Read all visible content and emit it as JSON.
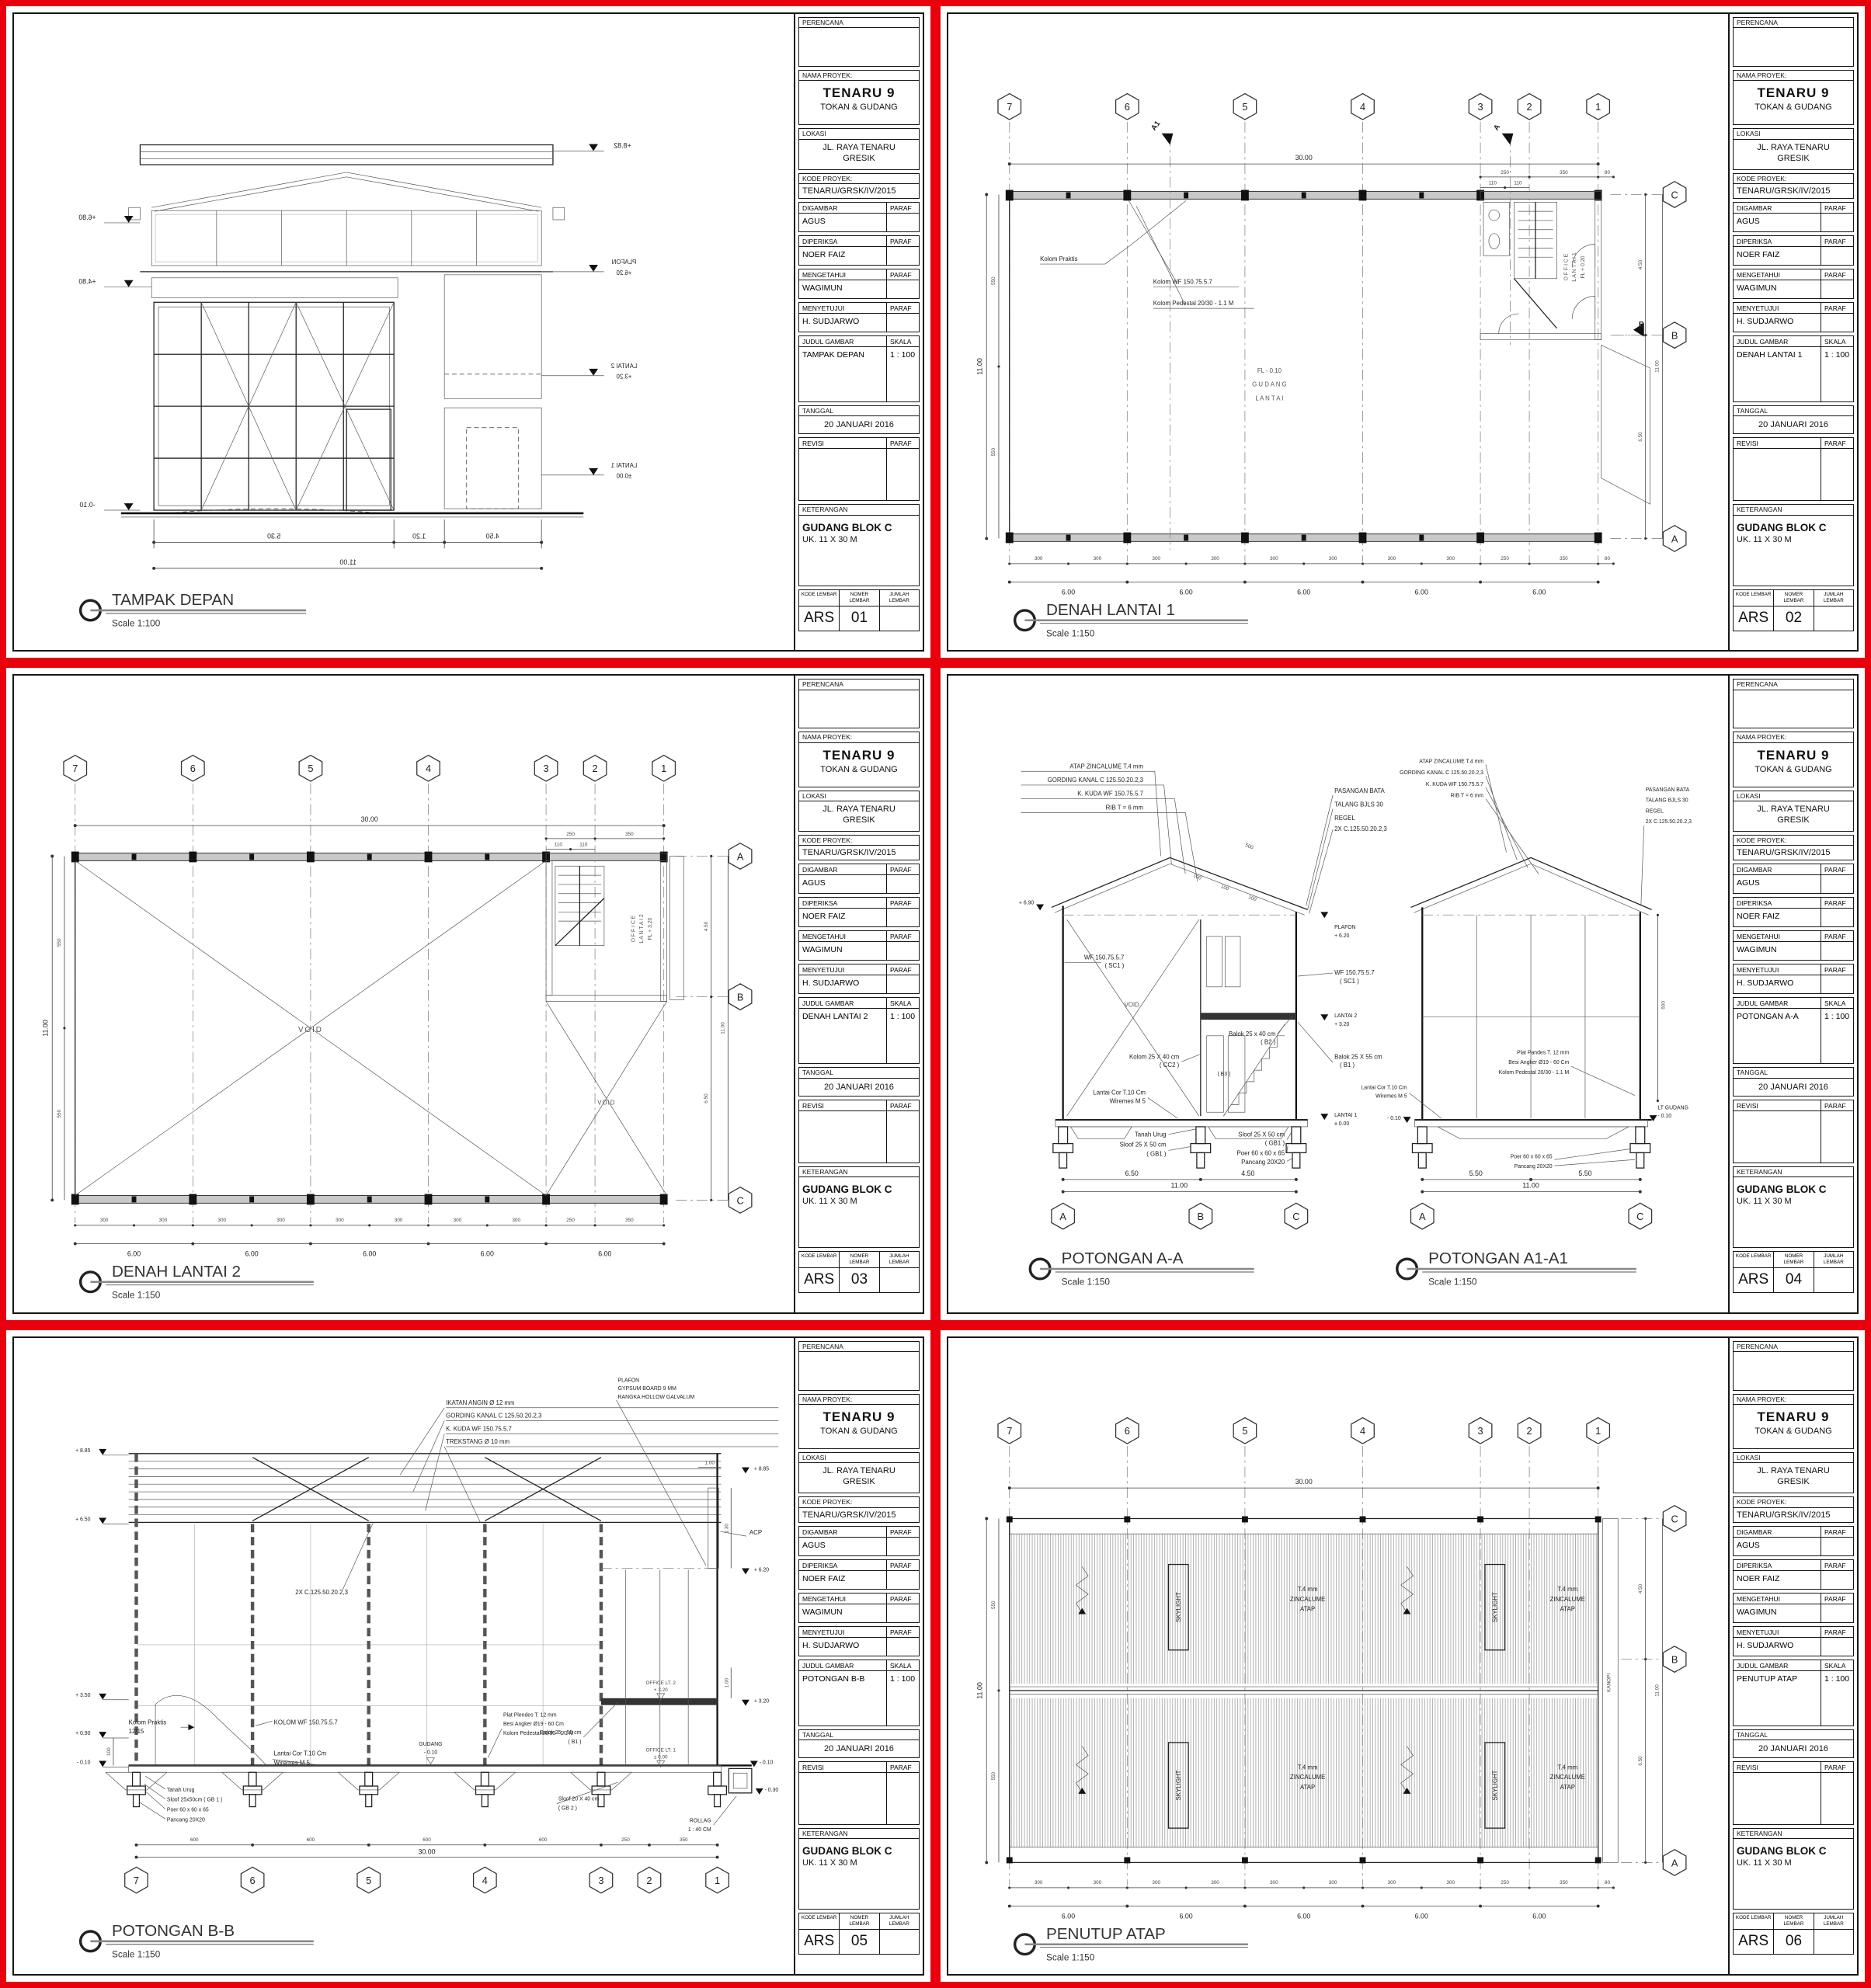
{
  "palette": {
    "separator_red": "#e8000d",
    "line_ink": "#161616"
  },
  "tb": {
    "perencana": "PERENCANA",
    "nama_proyek": "NAMA PROYEK:",
    "lokasi": "LOKASI",
    "kode_proyek": "KODE PROYEK:",
    "digambar": "DIGAMBAR",
    "diperiksa": "DIPERIKSA",
    "mengetahui": "MENGETAHUI",
    "menyetujui": "MENYETUJUI",
    "paraf": "PARAF",
    "judul_gambar": "JUDUL GAMBAR",
    "skala": "SKALA",
    "tanggal": "TANGGAL",
    "revisi": "REVISI",
    "keterangan": "KETERANGAN",
    "kode_lembar": "KODE LEMBAR",
    "nomer_lembar": "NOMER LEMBAR",
    "jumlah_lembar": "JUMLAH LEMBAR"
  },
  "project": {
    "name": "TENARU 9",
    "subtitle": "TOKAN & GUDANG",
    "lokasi_line1": "JL. RAYA TENARU",
    "lokasi_line2": "GRESIK",
    "kode": "TENARU/GRSK/IV/2015",
    "digambar": "AGUS",
    "diperiksa": "NOER FAIZ",
    "mengetahui": "WAGIMUN",
    "menyetujui": "H. SUDJARWO",
    "tanggal": "20 JANUARI 2016",
    "keterangan_line1": "GUDANG BLOK C",
    "keterangan_line2": "UK. 11 X 30 M",
    "kode_lembar": "ARS"
  },
  "grid": {
    "cols": [
      "7",
      "6",
      "5",
      "4",
      "3",
      "2",
      "1"
    ],
    "rows_cba": [
      "C",
      "B",
      "A"
    ],
    "rows_abc": [
      "A",
      "B",
      "C"
    ]
  },
  "dims": {
    "total_len": "30.00",
    "bay": "6.00",
    "width": "11.00",
    "half_bay": "300",
    "half_width": "550",
    "d250": "250",
    "d350": "350",
    "d80": "80",
    "d110": "110",
    "d450": "4.50",
    "d650": "6.50"
  },
  "sheets": [
    {
      "judul": "TAMPAK DEPAN",
      "skala": "1 : 100",
      "nomer": "01",
      "caption": "TAMPAK DEPAN",
      "caption_scale": "Scale 1:100",
      "d": {
        "lv882": "+8.82",
        "lv680": "+6.80",
        "plafon": "PLAFON",
        "lv620": "+6.20",
        "lv480": "+4.80",
        "lantai2": "LANTAI 2",
        "lv320": "+3.20",
        "lantai1": "LANTAI 1",
        "lv000": "±0.00",
        "lv010": "-0.10",
        "dim1": "5.30",
        "dim2": "1.20",
        "dim3": "4.50",
        "dim_total": "11.00"
      }
    },
    {
      "judul": "DENAH LANTAI 1",
      "skala": "1 : 100",
      "nomer": "02",
      "caption": "DENAH LANTAI 1",
      "caption_scale": "Scale 1:150",
      "d": {
        "sec_a1": "A1",
        "sec_a": "A",
        "sec_b": "B",
        "kolom_praktis": "Kolom Praktis",
        "kolom_wf": "Kolom WF 150.75.5.7",
        "kolom_ped": "Kolom Pedestal 20/30 - 1.1 M",
        "gudang1": "FL - 0.10",
        "gudang2": "G U D A N G",
        "gudang3": "L A N T A I",
        "office1": "O F F I C E",
        "office2": "L A N T A I  1",
        "office3": "FL + 0.20"
      }
    },
    {
      "judul": "DENAH LANTAI 2",
      "skala": "1 : 100",
      "nomer": "03",
      "caption": "DENAH LANTAI 2",
      "caption_scale": "Scale 1:150",
      "d": {
        "void": "VOID",
        "office1": "O F F I C E",
        "office2": "L A N T A I  2",
        "office3": "FL + 3.20"
      }
    },
    {
      "judul": "POTONGAN A-A",
      "skala": "1 : 100",
      "nomer": "04",
      "caption": "POTONGAN A-A",
      "caption_scale": "Scale 1:150",
      "caption2": "POTONGAN A1-A1",
      "caption2_scale": "Scale 1:150",
      "d": {
        "roof1": "ATAP ZINCALUME T.4 mm",
        "roof2": "GORDING KANAL C 125.50.20.2,3",
        "roof3": "K. KUDA WF 150.75.5.7",
        "roof4": "RIB T = 6 mm",
        "bata": "PASANGAN BATA",
        "talang": "TALANG BJLS 30",
        "regel": "REGEL",
        "c2x": "2X C.125.50.20.2,3",
        "plafon": "PLAFON",
        "lv620": "+ 6.20",
        "lv690": "+ 6.90",
        "wf": "WF 150.75.5.7",
        "sc1": "( SC1 )",
        "void": "VOID",
        "b2": "Balok 25 x 40 cm",
        "b2k": "( B2 )",
        "lantai2": "LANTAI 2",
        "lv320": "+ 3.20",
        "b1": "Balok 25 X 55 cm",
        "b1k": "( B1 )",
        "cc2": "Kolom 25 X 40 cm",
        "cc2k": "( CC2 )",
        "cor": "Lantai Cor T.10 Cm",
        "wiremes": "Wiremes M 5",
        "b3": "( B3 )",
        "tanah": "Tanah Urug",
        "gb1": "Sloof 25 X 50 cm",
        "gb1k": "( GB1 )",
        "poer": "Poer 60 x 60 x 65",
        "pancang": "Pancang 20X20",
        "lantai1": "LANTAI 1",
        "lv000": "± 0.00",
        "lv010": "- 0.10",
        "plat": "Plat Pandes T. 12 mm",
        "besi": "Besi Angker Ø19 - 60 Cm",
        "ped": "Kolom Pedestal 20/30 - 1.1 M",
        "ltgudang": "LT GUDANG",
        "d500": "500",
        "d100": "100",
        "d600": "600",
        "d650": "6.50",
        "d450": "4.50",
        "d1100": "11.00",
        "d550": "5.50",
        "gA": "A",
        "gB": "B",
        "gC": "C"
      }
    },
    {
      "judul": "POTONGAN B-B",
      "skala": "1 : 100",
      "nomer": "05",
      "caption": "POTONGAN B-B",
      "caption_scale": "Scale 1:150",
      "d": {
        "note1": "IKATAN ANGIN Ø 12 mm",
        "note2": "GORDING KANAL C 125.50.20.2,3",
        "note3": "K. KUDA WF 150.75.5.7",
        "note4": "TREKSTANG Ø 10 mm",
        "plafon1": "PLAFON",
        "plafon2": "GYPSUM BOARD 9 MM",
        "plafon3": "RANGKA HOLLOW GALVALUM",
        "acp": "ACP",
        "c2x": "2X C.125.50.20.2,3",
        "lvl1": "+ 8.85",
        "lvl2": "+ 6.50",
        "lvl3": "+ 3.50",
        "lvl4": "+ 0.90",
        "lvl5": "- 0.10",
        "lvr1": "+ 8.85",
        "lvr2": "+ 6.20",
        "lvr3": "+ 3.20",
        "lvr4": "- 0.10",
        "lvr5": "- 0.30",
        "d100": "1.00",
        "d130": "1.30",
        "t100": "100",
        "kp1": "Kolom Praktis",
        "kp2": "12/15",
        "kwf": "KOLOM WF 150.75.5.7",
        "cor": "Lantai Cor T.10 Cm",
        "wiremes": "Wiremes M 5",
        "gudang": "GUDANG",
        "gudang_lv": "- 0.10",
        "plat": "Plat Plendes T. 12 mm",
        "besi": "Besi Angker Ø19 - 60 Cm",
        "ped": "Kolom Pedestal 20/30 - 1.1 M",
        "tanah": "Tanah Urug",
        "gb1": "Sloof 25x50cm ( GB 1 )",
        "poer": "Poer 60 x 60 x 65",
        "pancang": "Pancang 20X20",
        "off2": "OFFICE LT. 2",
        "off2lv": "+ 3.20",
        "off1": "OFFICE LT. 1",
        "off1lv": "± 0.00",
        "b1": "Balok 25 x 55 cm",
        "b1k": "( B1 )",
        "gb2": "Sloof 20 X 40 cm",
        "gb2k": "( GB 2 )",
        "rollag1": "ROLLAG",
        "rollag2": "1 : 40 CM",
        "d600": "600",
        "d250": "250",
        "d350": "350",
        "d3000": "30.00"
      }
    },
    {
      "judul": "PENUTUP ATAP",
      "skala": "1 : 100",
      "nomer": "06",
      "caption": "PENUTUP ATAP",
      "caption_scale": "Scale 1:150",
      "d": {
        "skylight": "SKYLIGHT",
        "z1": "T.4 mm",
        "z2": "ZINCALUME",
        "z3": "ATAP",
        "kanopi": "KANOPI"
      }
    }
  ]
}
